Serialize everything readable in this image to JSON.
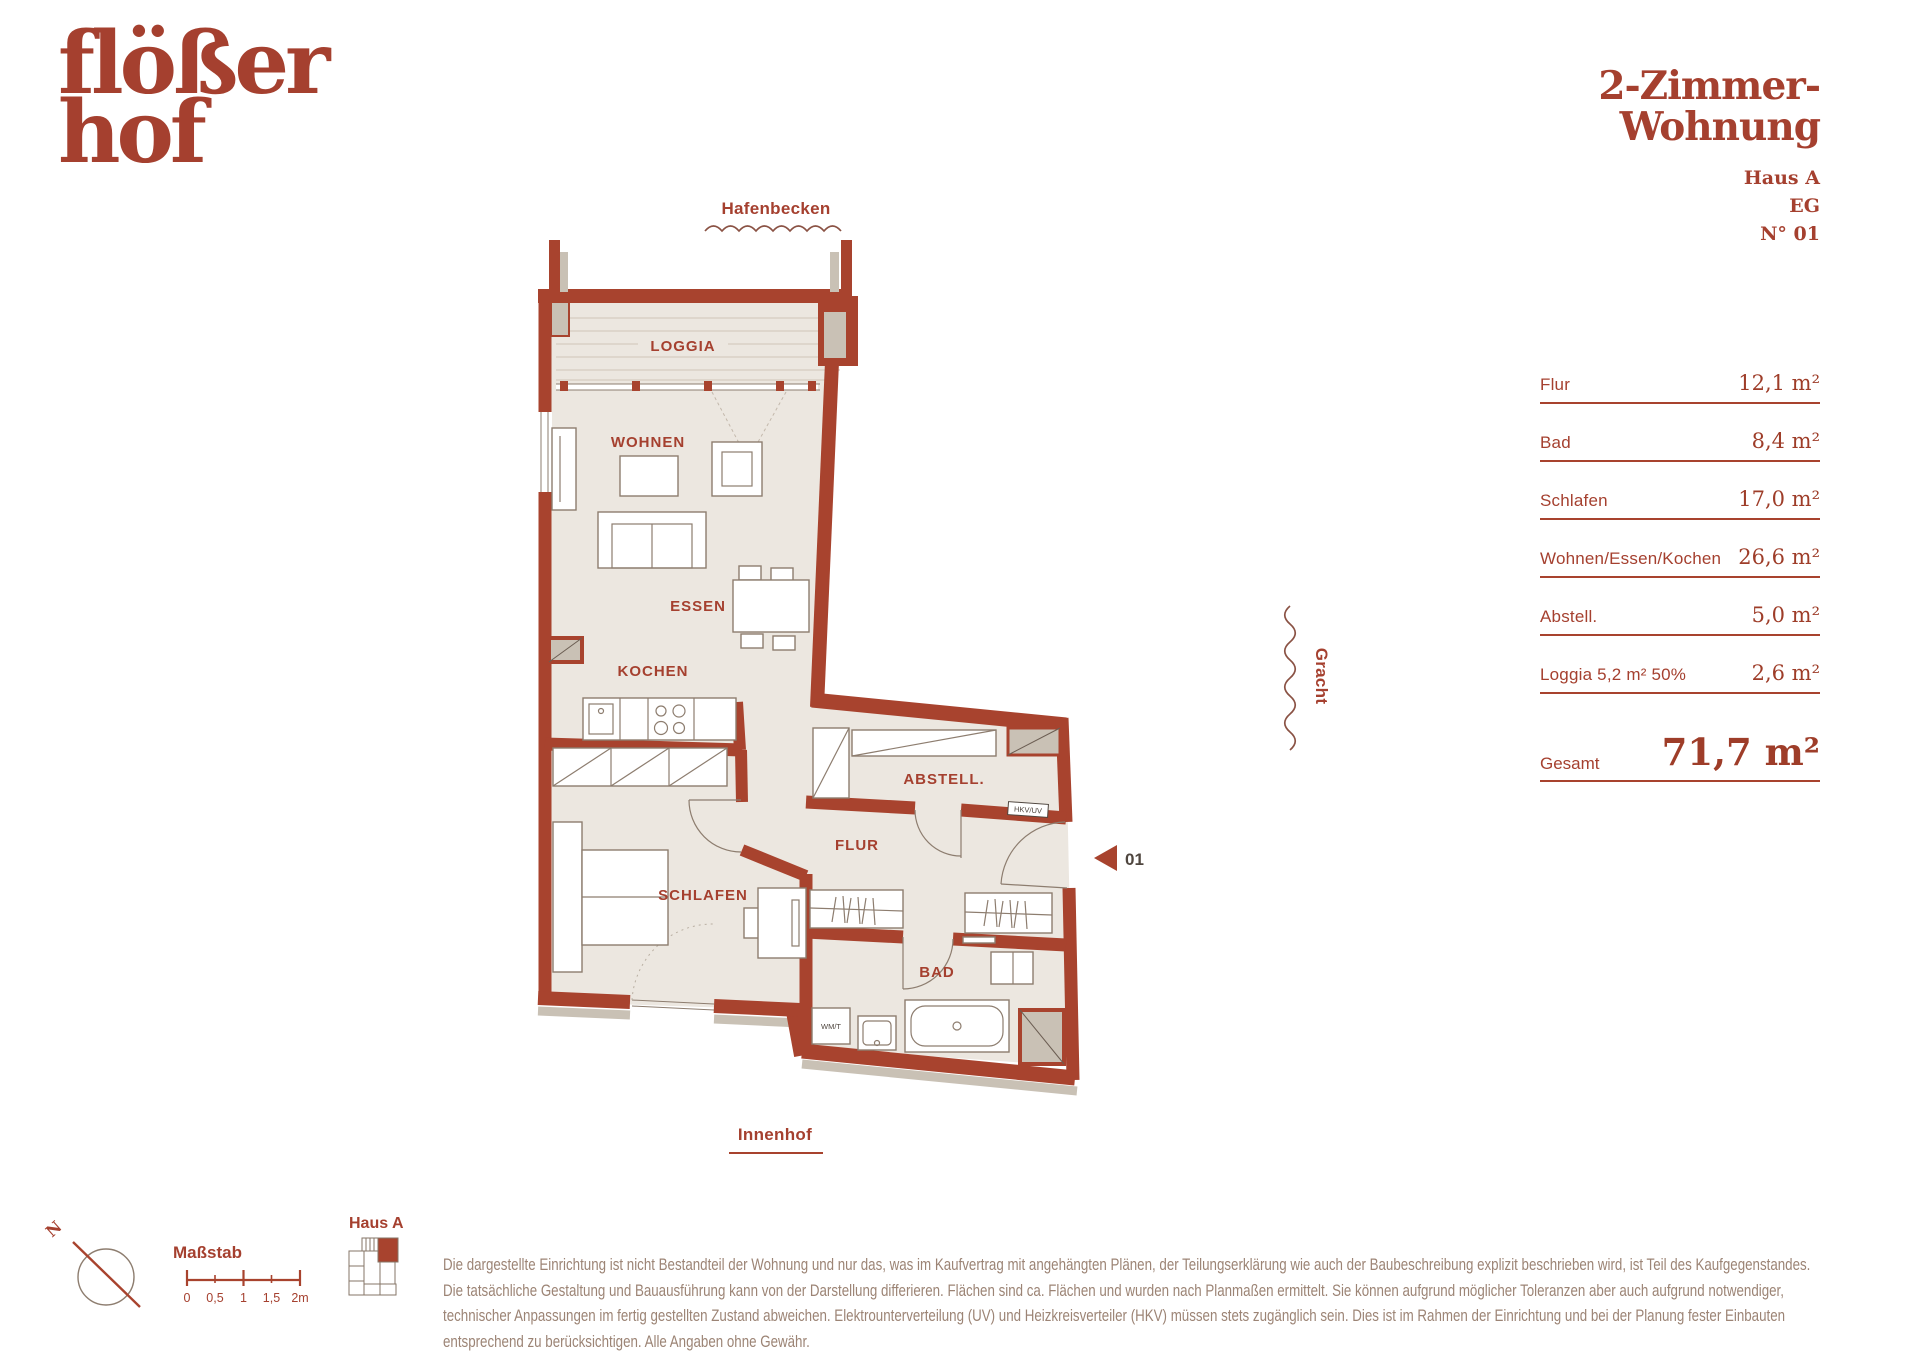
{
  "brand": {
    "line1": "flößer",
    "line2": "hof"
  },
  "title": {
    "line1": "2-Zimmer-",
    "line2": "Wohnung",
    "building": "Haus A",
    "level": "EG",
    "unit": "N° 01"
  },
  "surroundings": {
    "top": "Hafenbecken",
    "right": "Gracht",
    "bottom": "Innenhof"
  },
  "plan": {
    "rooms": {
      "loggia": "LOGGIA",
      "wohnen": "WOHNEN",
      "essen": "ESSEN",
      "kochen": "KOCHEN",
      "abstell": "ABSTELL.",
      "flur": "FLUR",
      "schlafen": "SCHLAFEN",
      "bad": "BAD"
    },
    "appliances": {
      "wm": "WM/T",
      "hkv": "HKV/UV"
    },
    "entry": {
      "number": "01"
    }
  },
  "area_table": {
    "rows": [
      {
        "label": "Flur",
        "value": "12,1 m²"
      },
      {
        "label": "Bad",
        "value": "8,4 m²"
      },
      {
        "label": "Schlafen",
        "value": "17,0 m²"
      },
      {
        "label": "Wohnen/Essen/Kochen",
        "value": "26,6 m²"
      },
      {
        "label": "Abstell.",
        "value": "5,0 m²"
      },
      {
        "label": "Loggia 5,2 m² 50%",
        "value": "2,6 m²"
      }
    ],
    "total": {
      "label": "Gesamt",
      "value": "71,7 m²"
    }
  },
  "footer": {
    "compass": {
      "label": "N"
    },
    "scale": {
      "label": "Maßstab",
      "ticks": [
        "0",
        "0,5",
        "1",
        "1,5",
        "2m"
      ]
    },
    "keyplan": {
      "label": "Haus A"
    },
    "disclaimer": "Die dargestellte Einrichtung ist nicht Bestandteil der Wohnung und nur das, was im Kaufvertrag mit angehängten Plänen, der Teilungserklärung wie auch der Baubeschreibung explizit beschrieben wird, ist Teil des Kaufgegenstandes. Die tatsächliche Gestaltung und Bauausführung kann von der Darstellung differieren. Flächen sind ca. Flächen und wurden nach Planmaßen ermittelt. Sie können aufgrund möglicher Toleranzen aber auch aufgrund notwendiger, technischer Anpassungen im fertig gestellten Zustand abweichen. Elektrounterverteilung (UV) und Heizkreisverteiler (HKV) müssen stets zugänglich sein. Dies ist im Rahmen der Einrichtung und bei der Planung fester Einbauten entsprechend zu berücksichtigen. Alle Angaben ohne Gewähr."
  },
  "colors": {
    "brick": "#A8432E",
    "floor": "#ECE7E0",
    "accent_text": "#A5402F"
  }
}
